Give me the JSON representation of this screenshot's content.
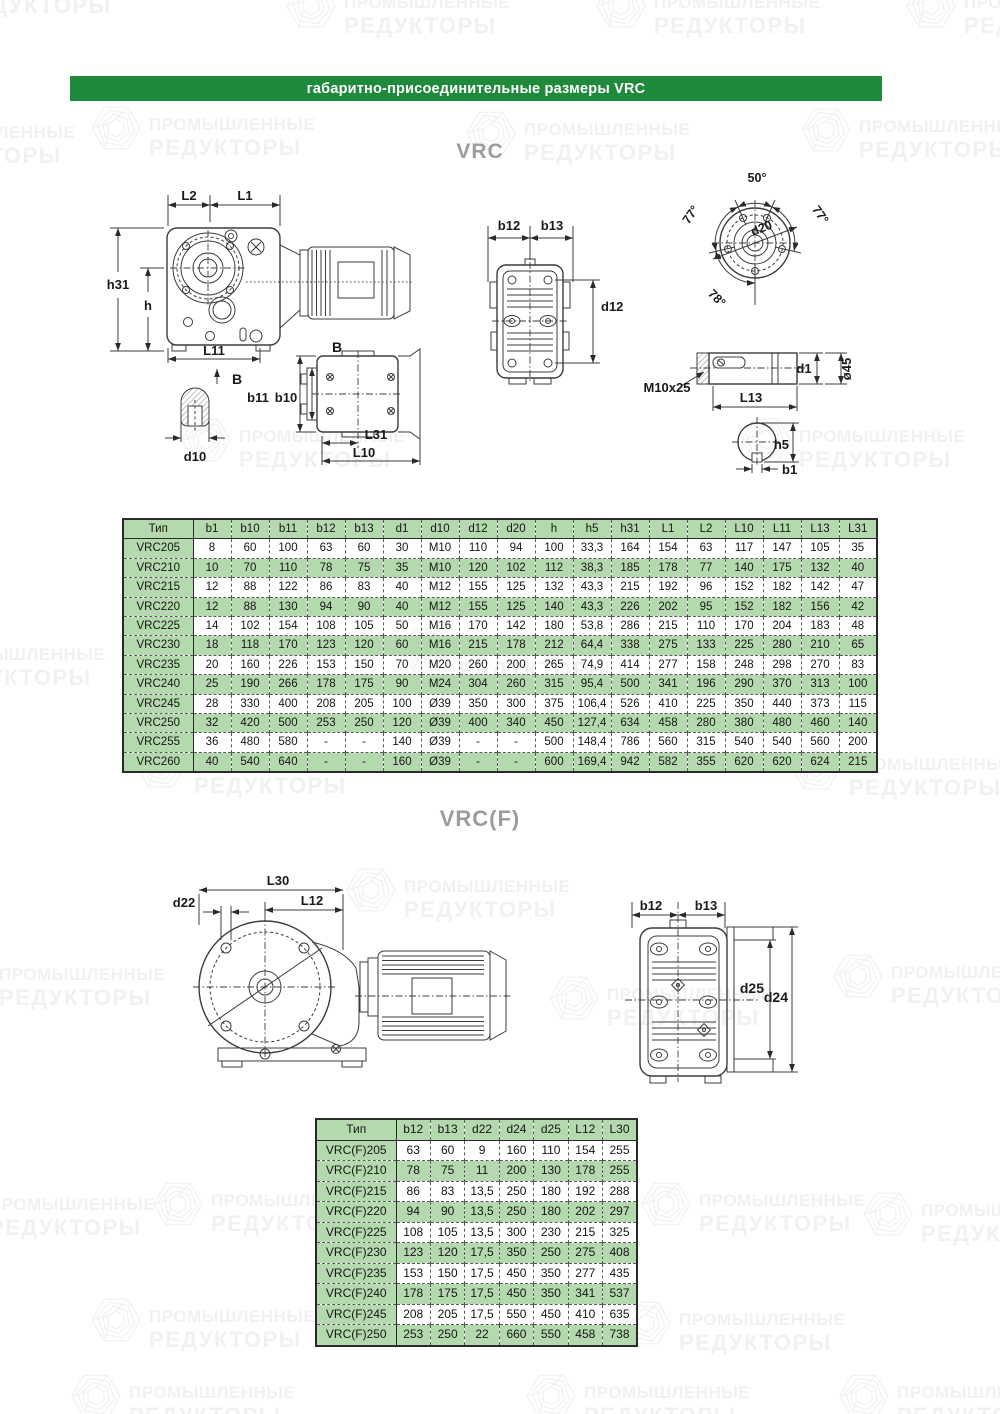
{
  "banner": {
    "text": "габаритно-присоединительные размеры VRC"
  },
  "watermark": {
    "line1": "ПРОМЫШЛЕННЫЕ",
    "line2": "РЕДУКТОРЫ"
  },
  "sections": {
    "vrc": {
      "title": "VRC"
    },
    "vrcf": {
      "title": "VRC(F)"
    }
  },
  "drawing_labels": {
    "vrc": {
      "L2": "L2",
      "L1": "L1",
      "h31": "h31",
      "h": "h",
      "L11": "L11",
      "B_cut": "B",
      "B_view": "B",
      "d10": "d10",
      "b11": "b11",
      "b10": "b10",
      "L31": "L31",
      "L10": "L10",
      "b12": "b12",
      "b13": "b13",
      "d12": "d12",
      "a50": "50°",
      "a77L": "77°",
      "a77R": "77°",
      "a78": "78°",
      "d20": "d20",
      "thread": "M10x25",
      "L13": "L13",
      "d1": "d1",
      "dia45": "ø45",
      "h5": "h5",
      "b1": "b1"
    },
    "vrcf": {
      "L30": "L30",
      "L12": "L12",
      "d22": "d22",
      "b12": "b12",
      "b13": "b13",
      "d25": "d25",
      "d24": "d24"
    }
  },
  "tables": {
    "vrc": {
      "columns": [
        "Тип",
        "b1",
        "b10",
        "b11",
        "b12",
        "b13",
        "d1",
        "d10",
        "d12",
        "d20",
        "h",
        "h5",
        "h31",
        "L1",
        "L2",
        "L10",
        "L11",
        "L13",
        "L31"
      ],
      "rows": [
        [
          "VRC205",
          "8",
          "60",
          "100",
          "63",
          "60",
          "30",
          "M10",
          "110",
          "94",
          "100",
          "33,3",
          "164",
          "154",
          "63",
          "117",
          "147",
          "105",
          "35"
        ],
        [
          "VRC210",
          "10",
          "70",
          "110",
          "78",
          "75",
          "35",
          "M10",
          "120",
          "102",
          "112",
          "38,3",
          "185",
          "178",
          "77",
          "140",
          "175",
          "132",
          "40"
        ],
        [
          "VRC215",
          "12",
          "88",
          "122",
          "86",
          "83",
          "40",
          "M12",
          "155",
          "125",
          "132",
          "43,3",
          "215",
          "192",
          "96",
          "152",
          "182",
          "142",
          "47"
        ],
        [
          "VRC220",
          "12",
          "88",
          "130",
          "94",
          "90",
          "40",
          "M12",
          "155",
          "125",
          "140",
          "43,3",
          "226",
          "202",
          "95",
          "152",
          "182",
          "156",
          "42"
        ],
        [
          "VRC225",
          "14",
          "102",
          "154",
          "108",
          "105",
          "50",
          "M16",
          "170",
          "142",
          "180",
          "53,8",
          "286",
          "215",
          "110",
          "170",
          "204",
          "183",
          "48"
        ],
        [
          "VRC230",
          "18",
          "118",
          "170",
          "123",
          "120",
          "60",
          "M16",
          "215",
          "178",
          "212",
          "64,4",
          "338",
          "275",
          "133",
          "225",
          "280",
          "210",
          "65"
        ],
        [
          "VRC235",
          "20",
          "160",
          "226",
          "153",
          "150",
          "70",
          "M20",
          "260",
          "200",
          "265",
          "74,9",
          "414",
          "277",
          "158",
          "248",
          "298",
          "270",
          "83"
        ],
        [
          "VRC240",
          "25",
          "190",
          "266",
          "178",
          "175",
          "90",
          "M24",
          "304",
          "260",
          "315",
          "95,4",
          "500",
          "341",
          "196",
          "290",
          "370",
          "313",
          "100"
        ],
        [
          "VRC245",
          "28",
          "330",
          "400",
          "208",
          "205",
          "100",
          "Ø39",
          "350",
          "300",
          "375",
          "106,4",
          "526",
          "410",
          "225",
          "350",
          "440",
          "373",
          "115"
        ],
        [
          "VRC250",
          "32",
          "420",
          "500",
          "253",
          "250",
          "120",
          "Ø39",
          "400",
          "340",
          "450",
          "127,4",
          "634",
          "458",
          "280",
          "380",
          "480",
          "460",
          "140"
        ],
        [
          "VRC255",
          "36",
          "480",
          "580",
          "-",
          "-",
          "140",
          "Ø39",
          "-",
          "-",
          "500",
          "148,4",
          "786",
          "560",
          "315",
          "540",
          "540",
          "560",
          "200"
        ],
        [
          "VRC260",
          "40",
          "540",
          "640",
          "-",
          "-",
          "160",
          "Ø39",
          "-",
          "-",
          "600",
          "169,4",
          "942",
          "582",
          "355",
          "620",
          "620",
          "624",
          "215"
        ]
      ]
    },
    "vrcf": {
      "columns": [
        "Тип",
        "b12",
        "b13",
        "d22",
        "d24",
        "d25",
        "L12",
        "L30"
      ],
      "rows": [
        [
          "VRC(F)205",
          "63",
          "60",
          "9",
          "160",
          "110",
          "154",
          "255"
        ],
        [
          "VRC(F)210",
          "78",
          "75",
          "11",
          "200",
          "130",
          "178",
          "255"
        ],
        [
          "VRC(F)215",
          "86",
          "83",
          "13,5",
          "250",
          "180",
          "192",
          "288"
        ],
        [
          "VRC(F)220",
          "94",
          "90",
          "13,5",
          "250",
          "180",
          "202",
          "297"
        ],
        [
          "VRC(F)225",
          "108",
          "105",
          "13,5",
          "300",
          "230",
          "215",
          "325"
        ],
        [
          "VRC(F)230",
          "123",
          "120",
          "17,5",
          "350",
          "250",
          "275",
          "408"
        ],
        [
          "VRC(F)235",
          "153",
          "150",
          "17,5",
          "450",
          "350",
          "277",
          "435"
        ],
        [
          "VRC(F)240",
          "178",
          "175",
          "17,5",
          "450",
          "350",
          "341",
          "537"
        ],
        [
          "VRC(F)245",
          "208",
          "205",
          "17,5",
          "550",
          "450",
          "410",
          "635"
        ],
        [
          "VRC(F)250",
          "253",
          "250",
          "22",
          "660",
          "550",
          "458",
          "738"
        ]
      ]
    }
  },
  "colors": {
    "banner_green": "#1f8a3c",
    "table_green": "#b5d9ae",
    "line": "#3c3c3c"
  }
}
